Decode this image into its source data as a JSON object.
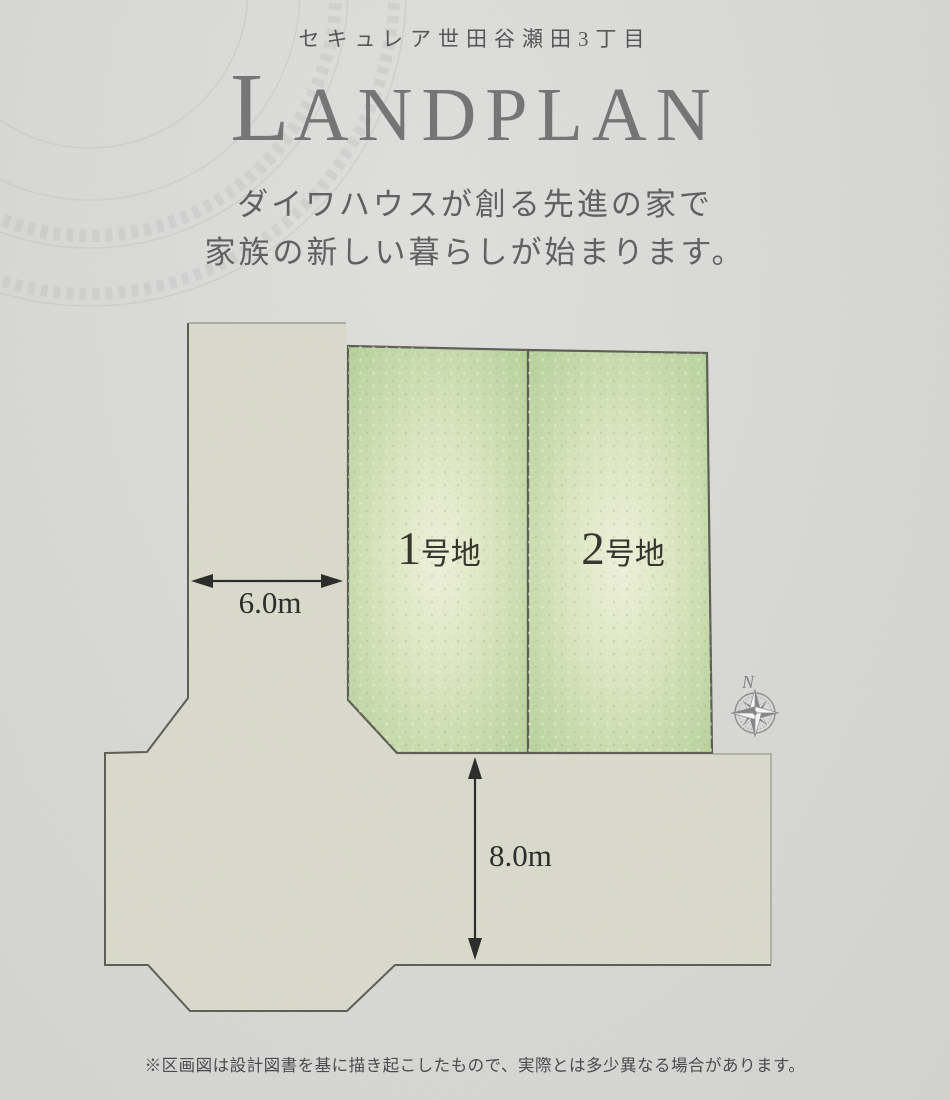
{
  "header": {
    "project_name": "セキュレア世田谷瀬田3丁目",
    "title_initial": "L",
    "title_rest": "ANDPLAN",
    "tagline_line1": "ダイワハウスが創る先進の家で",
    "tagline_line2": "家族の新しい暮らしが始まります。"
  },
  "plan": {
    "plots": [
      {
        "number": "1",
        "suffix": "号地"
      },
      {
        "number": "2",
        "suffix": "号地"
      }
    ],
    "dimensions": [
      {
        "label": "6.0m",
        "orientation": "horizontal",
        "measures": "road width"
      },
      {
        "label": "8.0m",
        "orientation": "vertical",
        "measures": "road width"
      }
    ],
    "compass": {
      "north_label": "N"
    },
    "colors": {
      "background": "#d8d9d7",
      "road_fill": "#dadbca",
      "plot_green_edge": "#b3d197",
      "plot_green_center": "#f2f4dd",
      "outline": "#53534a",
      "title_gray": "#6c6c6c"
    }
  },
  "footer": {
    "note": "※区画図は設計図書を基に描き起こしたもので、実際とは多少異なる場合があります。"
  }
}
